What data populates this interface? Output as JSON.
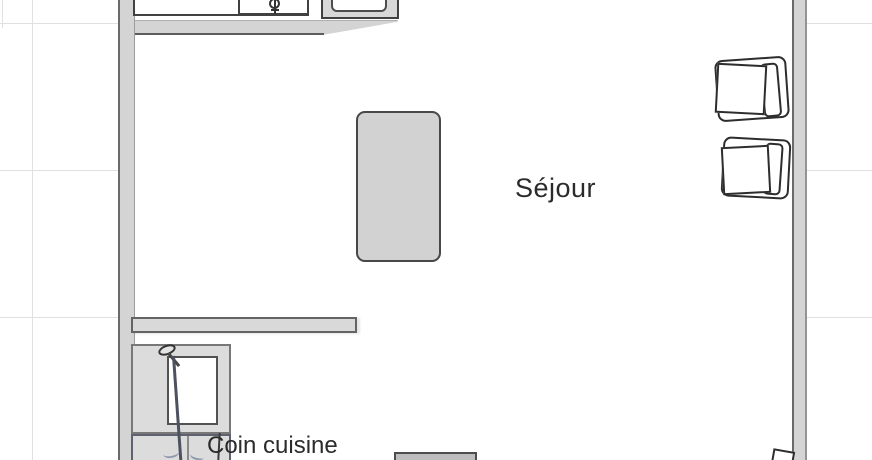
{
  "canvas": {
    "width_px": 872,
    "height_px": 460
  },
  "room_labels": {
    "living_room": "Séjour",
    "kitchen_corner": "Coin cuisine"
  },
  "colors": {
    "background": "#ffffff",
    "grid": "#e0e0e0",
    "wall-fill": "#d4d4d4",
    "wall-edge": "#6a6a6a",
    "furniture-fill": "#d2d2d2",
    "unit-fill": "#dcdcdc",
    "door-line": "#4d5160",
    "text": "#2b2b2b",
    "faint-artifact": "#ececec",
    "sketch-blue": "#8d97ae"
  },
  "objects": [
    {
      "name": "kitchen-counter"
    },
    {
      "name": "sink-drain-icon"
    },
    {
      "name": "cooktop"
    },
    {
      "name": "dining-table"
    },
    {
      "name": "chair",
      "count": 2
    },
    {
      "name": "chair-partial"
    },
    {
      "name": "kitchenette-unit"
    },
    {
      "name": "door-leaf"
    },
    {
      "name": "sideboard-partial"
    }
  ]
}
